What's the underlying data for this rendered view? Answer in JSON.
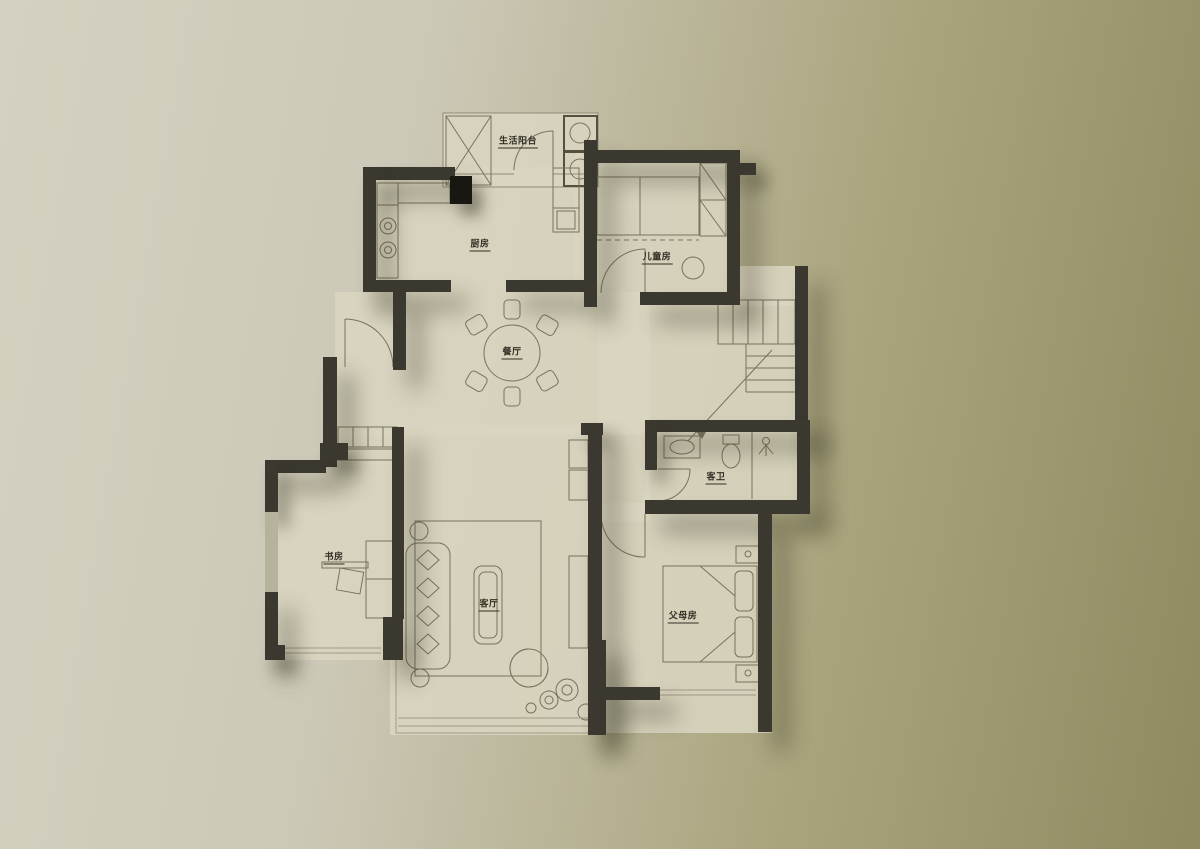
{
  "colors": {
    "bg-left": "#d5d1c2",
    "bg-right": "#8f8a60",
    "floor": "#d9d5c0",
    "wall": "#3b382f",
    "appliance": "#191711",
    "line": "#6e6852",
    "line-light": "#9b9580",
    "label": "#332f24",
    "shadow": "rgba(52,48,30,0.45)"
  },
  "plan": {
    "rooms": [
      {
        "id": "balcony",
        "label": "生活阳台"
      },
      {
        "id": "kitchen",
        "label": "厨房"
      },
      {
        "id": "kids",
        "label": "儿童房"
      },
      {
        "id": "dining",
        "label": "餐厅"
      },
      {
        "id": "bath",
        "label": "客卫"
      },
      {
        "id": "study",
        "label": "书房"
      },
      {
        "id": "living",
        "label": "客厅"
      },
      {
        "id": "parents",
        "label": "父母房"
      }
    ]
  }
}
